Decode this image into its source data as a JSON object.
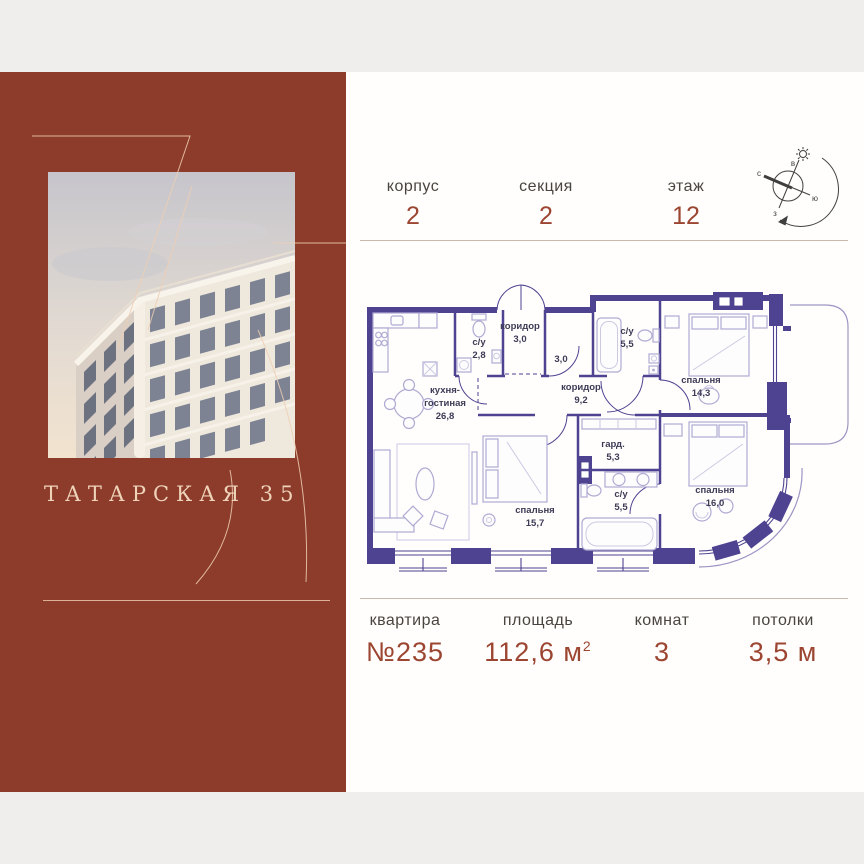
{
  "brand": {
    "title": "ТАТАРСКАЯ 35"
  },
  "header": {
    "stats": [
      {
        "label": "корпус",
        "value": "2"
      },
      {
        "label": "секция",
        "value": "2"
      },
      {
        "label": "этаж",
        "value": "12"
      }
    ],
    "compass": {
      "north": "с",
      "east": "в",
      "south": "ю",
      "west": "з"
    }
  },
  "plan": {
    "rooms": [
      {
        "name": "коридор",
        "area": "3,0"
      },
      {
        "name": "с/у",
        "area": "2,8"
      },
      {
        "name": "",
        "area": "3,0"
      },
      {
        "name": "с/у",
        "area": "5,5"
      },
      {
        "name": "коридор",
        "area": "9,2"
      },
      {
        "name": "кухня-",
        "name2": "гостиная",
        "area": "26,8"
      },
      {
        "name": "спальня",
        "area": "15,7"
      },
      {
        "name": "гард.",
        "area": "5,3"
      },
      {
        "name": "с/у",
        "area": "5,5"
      },
      {
        "name": "спальня",
        "area": "14,3"
      },
      {
        "name": "спальня",
        "area": "16,0"
      }
    ]
  },
  "footer": {
    "stats": [
      {
        "label": "квартира",
        "value": "№235"
      },
      {
        "label": "площадь",
        "value": "112,6 м",
        "sup": "2"
      },
      {
        "label": "комнат",
        "value": "3"
      },
      {
        "label": "потолки",
        "value": "3,5 м"
      }
    ]
  },
  "colors": {
    "accent": "#9c4531",
    "panel": "#8d3c2b",
    "wall": "#4e4390"
  }
}
